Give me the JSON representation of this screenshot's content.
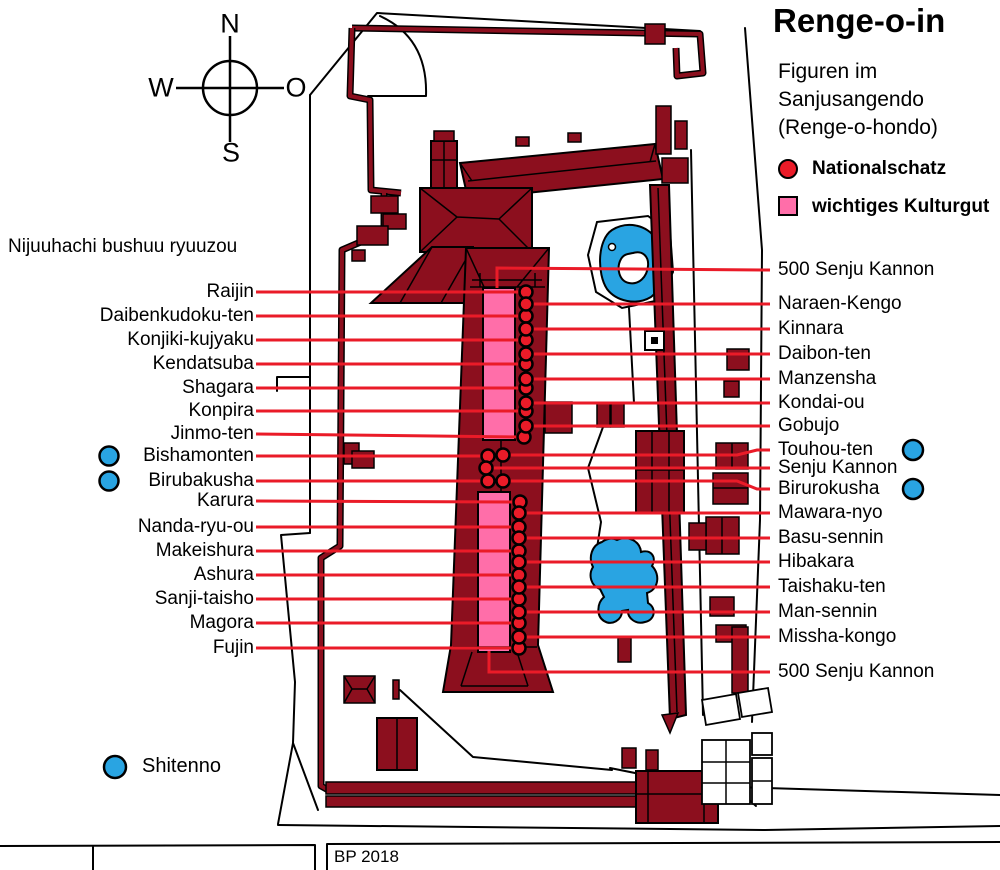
{
  "title": "Renge-o-in",
  "subtitle": {
    "line1": "Figuren im",
    "line2": "Sanjusangendo",
    "line3": "(Renge-o-hondo)"
  },
  "legend": {
    "national_treasure": "Nationalschatz",
    "important_cultural_property": "wichtiges Kulturgut"
  },
  "compass": {
    "north": "N",
    "south": "S",
    "west": "W",
    "east": "O"
  },
  "left_group_heading": "Nijuuhachi bushuu ryuuzou",
  "shitenno": {
    "label": "Shitenno",
    "circle": {
      "x": 115,
      "y": 767,
      "r": 11
    }
  },
  "credit": "BP 2018",
  "colors": {
    "building_maroon": "#8C0F1E",
    "highlight_pink": "#FF6EA9",
    "marker_red": "#EA1B28",
    "water_blue": "#29A4E2"
  },
  "figures": {
    "left": [
      {
        "name": "Raijin",
        "y": 292,
        "marker": {
          "x": 526,
          "y": 292
        }
      },
      {
        "name": "Daibenkudoku-ten",
        "y": 316,
        "marker": {
          "x": 526,
          "y": 316
        }
      },
      {
        "name": "Konjiki-kujyaku",
        "y": 340,
        "marker": {
          "x": 526,
          "y": 340
        }
      },
      {
        "name": "Kendatsuba",
        "y": 364,
        "marker": {
          "x": 526,
          "y": 364
        }
      },
      {
        "name": "Shagara",
        "y": 388,
        "marker": {
          "x": 526,
          "y": 388
        }
      },
      {
        "name": "Konpira",
        "y": 411,
        "marker": {
          "x": 526,
          "y": 411
        }
      },
      {
        "name": "Jinmo-ten",
        "y": 434,
        "marker": {
          "x": 524,
          "y": 437
        }
      },
      {
        "name": "Bishamonten",
        "y": 456,
        "marker": {
          "x": 488,
          "y": 456
        },
        "blue_circle": {
          "x": 109,
          "y": 456,
          "r": 9.5
        }
      },
      {
        "name": "Birubakusha",
        "y": 481,
        "marker": {
          "x": 488,
          "y": 481
        },
        "blue_circle": {
          "x": 109,
          "y": 481,
          "r": 9.5
        }
      },
      {
        "name": "Karura",
        "y": 501,
        "marker": {
          "x": 520,
          "y": 502
        }
      },
      {
        "name": "Nanda-ryu-ou",
        "y": 527,
        "marker": {
          "x": 519,
          "y": 527
        }
      },
      {
        "name": "Makeishura",
        "y": 551,
        "marker": {
          "x": 519,
          "y": 551
        }
      },
      {
        "name": "Ashura",
        "y": 575,
        "marker": {
          "x": 519,
          "y": 575
        }
      },
      {
        "name": "Sanji-taisho",
        "y": 599,
        "marker": {
          "x": 519,
          "y": 599
        }
      },
      {
        "name": "Magora",
        "y": 623,
        "marker": {
          "x": 519,
          "y": 623
        }
      },
      {
        "name": "Fujin",
        "y": 648,
        "marker": {
          "x": 519,
          "y": 648
        }
      }
    ],
    "right": [
      {
        "name": "500 Senju Kannon",
        "y": 270,
        "points": [
          [
            497,
            288
          ],
          [
            497,
            268
          ],
          [
            770,
            270
          ]
        ]
      },
      {
        "name": "Naraen-Kengo",
        "y": 304,
        "marker": {
          "x": 526,
          "y": 304
        }
      },
      {
        "name": "Kinnara",
        "y": 329,
        "marker": {
          "x": 526,
          "y": 329
        }
      },
      {
        "name": "Daibon-ten",
        "y": 354,
        "marker": {
          "x": 526,
          "y": 354
        }
      },
      {
        "name": "Manzensha",
        "y": 379,
        "marker": {
          "x": 526,
          "y": 379
        }
      },
      {
        "name": "Kondai-ou",
        "y": 403,
        "marker": {
          "x": 526,
          "y": 403
        }
      },
      {
        "name": "Gobujo",
        "y": 426,
        "marker": {
          "x": 526,
          "y": 426
        }
      },
      {
        "name": "Touhou-ten",
        "y": 450,
        "marker": {
          "x": 503,
          "y": 455
        },
        "points": [
          [
            503,
            455
          ],
          [
            737,
            455
          ],
          [
            757,
            450
          ],
          [
            770,
            450
          ]
        ],
        "blue_circle": {
          "x": 913,
          "y": 450,
          "r": 10
        }
      },
      {
        "name": "Senju Kannon",
        "y": 468,
        "marker": {
          "x": 486,
          "y": 468
        }
      },
      {
        "name": "Birurokusha",
        "y": 489,
        "marker": {
          "x": 503,
          "y": 481
        },
        "points": [
          [
            503,
            481
          ],
          [
            737,
            481
          ],
          [
            757,
            489
          ],
          [
            770,
            489
          ]
        ],
        "blue_circle": {
          "x": 913,
          "y": 489,
          "r": 10
        }
      },
      {
        "name": "Mawara-nyo",
        "y": 513,
        "marker": {
          "x": 519,
          "y": 513
        }
      },
      {
        "name": "Basu-sennin",
        "y": 538,
        "marker": {
          "x": 519,
          "y": 538
        }
      },
      {
        "name": "Hibakara",
        "y": 562,
        "marker": {
          "x": 519,
          "y": 562
        }
      },
      {
        "name": "Taishaku-ten",
        "y": 587,
        "marker": {
          "x": 519,
          "y": 587
        }
      },
      {
        "name": "Man-sennin",
        "y": 612,
        "marker": {
          "x": 519,
          "y": 612
        }
      },
      {
        "name": "Missha-kongo",
        "y": 637,
        "marker": {
          "x": 519,
          "y": 637
        }
      },
      {
        "name": "500 Senju Kannon",
        "y": 672,
        "points": [
          [
            489,
            651
          ],
          [
            489,
            672
          ],
          [
            770,
            672
          ]
        ]
      }
    ]
  }
}
